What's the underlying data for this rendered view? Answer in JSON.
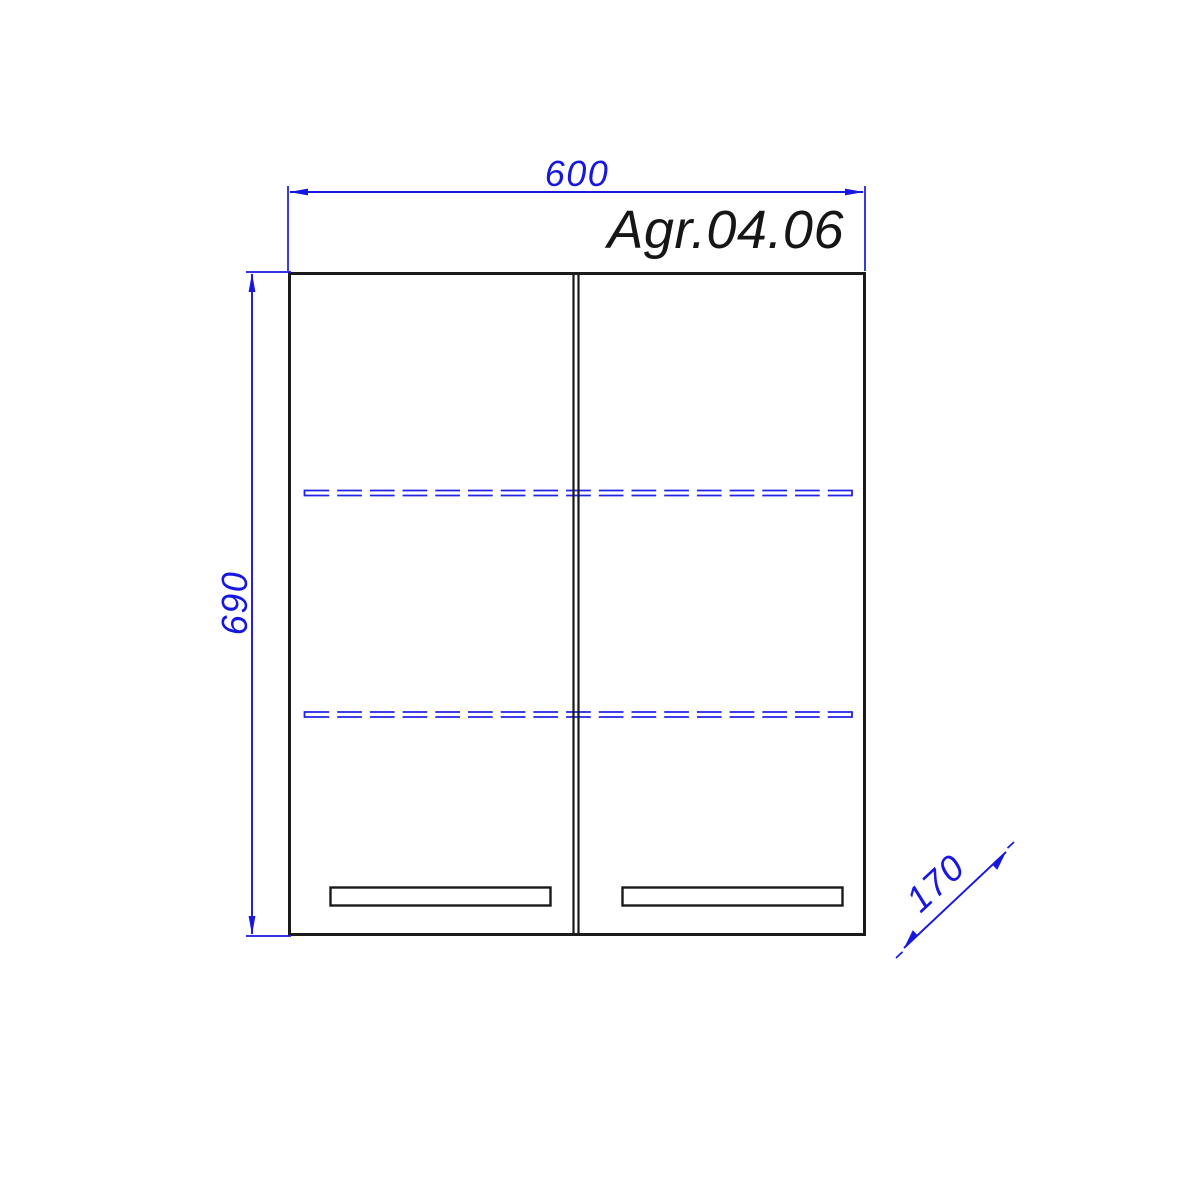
{
  "drawing": {
    "model_label": "Agr.04.06",
    "dim_width": "600",
    "dim_height": "690",
    "dim_depth": "170",
    "colors": {
      "dimension_blue": "#1717e0",
      "object_black": "#1a1a1a",
      "background": "#ffffff"
    }
  }
}
